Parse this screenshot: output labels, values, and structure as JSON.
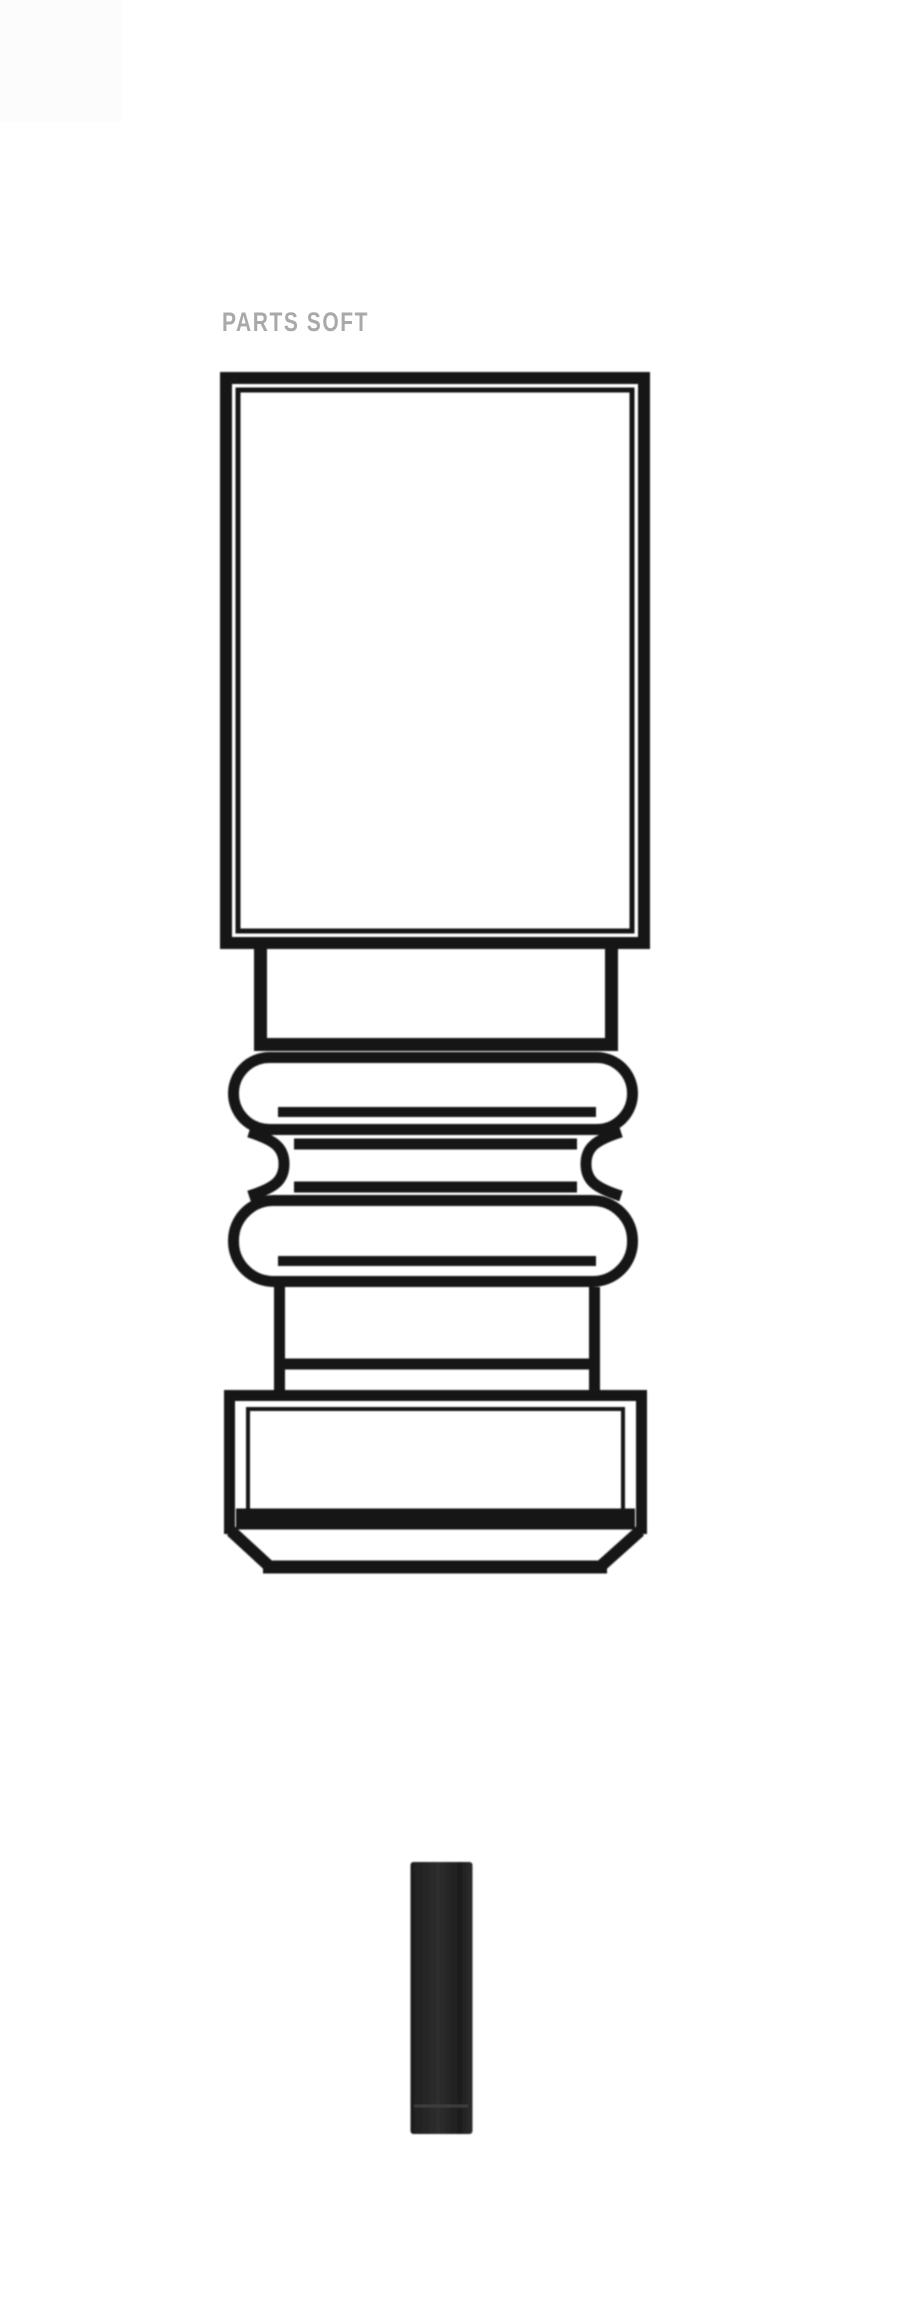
{
  "watermark": {
    "text": "PARTS SOFT"
  },
  "colors": {
    "background": "#ffffff",
    "placeholder_square": "#fcfcfc",
    "ink": "#181818",
    "watermark": "#a9a9a9",
    "stem_dark": "#1d1d1d",
    "stem_mid": "#2e2e2e",
    "stem_highlight": "#424242"
  },
  "drawing": {
    "subject": "engine valve technical line drawing",
    "parts": [
      "dash-dot centerline",
      "valve guide body",
      "upper stem section",
      "upper seal rib",
      "seal neck groove",
      "lower seal rib",
      "lower stem section",
      "valve head",
      "seat chamfer",
      "stem end piece"
    ]
  }
}
